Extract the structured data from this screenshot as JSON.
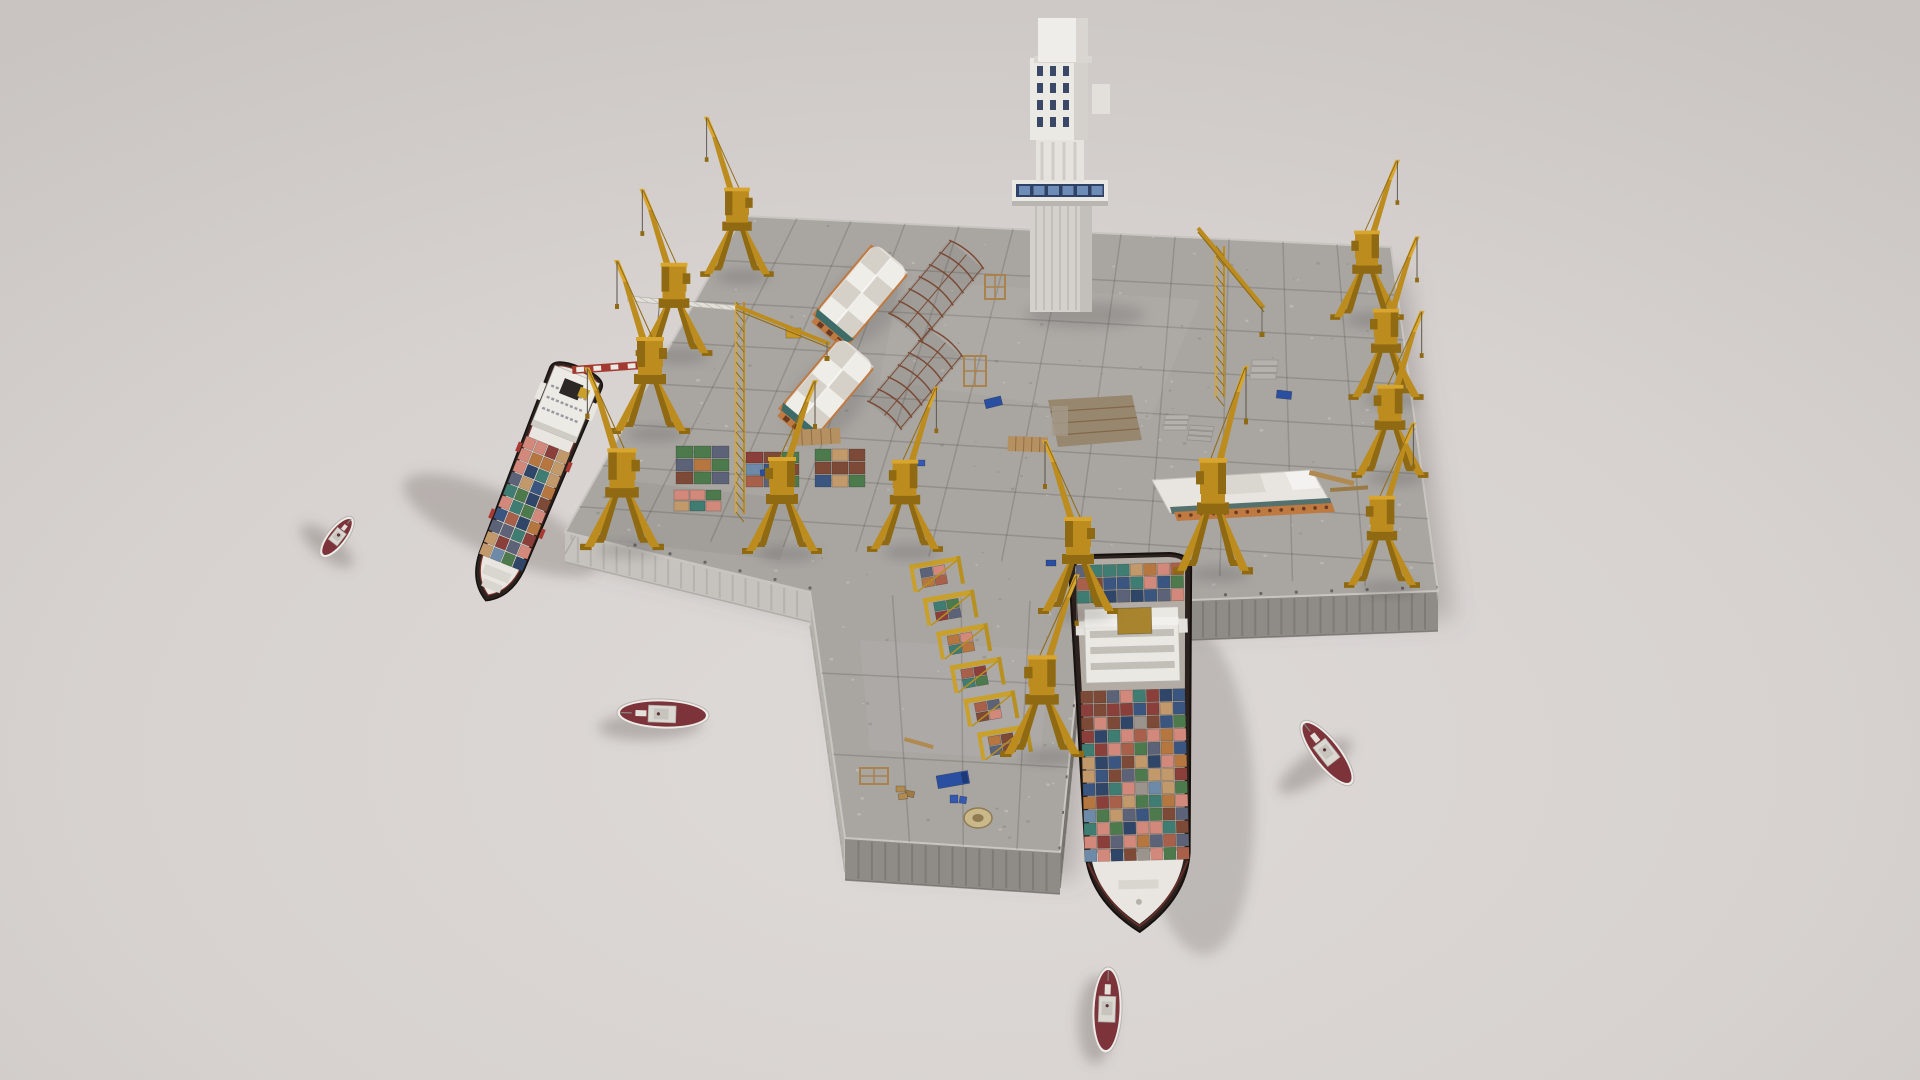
{
  "scene": {
    "description": "isometric-3d-render-of-cargo-harbor-diorama",
    "background": {
      "inner": "#dedad8",
      "mid": "#d7d2d0",
      "outer": "#c9c4c2"
    },
    "colors": {
      "pier": "#a9a6a2",
      "pierRim": "#c9c6c1",
      "wallSE": "#8f8b87",
      "wallSEDark": "#6e6a66",
      "wallSW": "#c6c2bd",
      "wallSWDark": "#a5a19c",
      "gridLine": "rgba(70,65,60,0.22)",
      "crane": "#bd8c1e",
      "craneDark": "#8f6a12",
      "craneLight": "#d8a62f",
      "towerFace": "#ebe9e4",
      "towerShade": "#d4d1cc",
      "towerWindow": "#2f4266",
      "towerPane": "#6d8cb8",
      "warehouseRoof": "#e2ded6",
      "warehouseWall": "#bf7a42",
      "warehouseGable": "#3d6b68",
      "skeleton": "#7a4a35",
      "shipHullDark": "#2b211e",
      "shipDeck": "#e9e6e1",
      "shipRed": "#a83a32",
      "shipRim": "#7e352f",
      "tugHull": "#ecebe7",
      "tugDeck": "#7c333a",
      "tugCabin": "#dbd8d2",
      "shadow": "rgba(106,96,92,0.32)",
      "wood": "#b08a50",
      "blueItem": "#2a4fa0",
      "mustard": "#a8842e"
    },
    "palette": [
      "#7d4a38",
      "#3a5680",
      "#3f7d72",
      "#8a3f3b",
      "#c2996b",
      "#d2897b",
      "#4d7a4c",
      "#5c6277",
      "#a8604a",
      "#2f4668",
      "#b5763f",
      "#6d8ba8"
    ],
    "pier": {
      "surface": [
        [
          743,
          216
        ],
        [
          1391,
          247
        ],
        [
          1438,
          591
        ],
        [
          1190,
          600
        ],
        [
          1085,
          603
        ],
        [
          1060,
          852
        ],
        [
          845,
          838
        ],
        [
          810,
          592
        ],
        [
          565,
          532
        ]
      ],
      "walls": [
        {
          "i": 2,
          "j": 3,
          "drop": 40,
          "face": "SE"
        },
        {
          "i": 3,
          "j": 4,
          "drop": 40,
          "face": "SE"
        },
        {
          "i": 4,
          "j": 5,
          "drop": 36,
          "face": "SE"
        },
        {
          "i": 5,
          "j": 6,
          "drop": 42,
          "face": "SE"
        },
        {
          "i": 6,
          "j": 7,
          "drop": 34,
          "face": "SW"
        },
        {
          "i": 7,
          "j": 8,
          "drop": 30,
          "face": "SW"
        },
        {
          "i": 8,
          "j": 0,
          "drop": 22,
          "face": "SW"
        },
        {
          "i": 1,
          "j": 2,
          "drop": 10,
          "face": "SW"
        }
      ],
      "gridT": [
        0.14,
        0.27,
        0.4,
        0.53,
        0.66,
        0.79,
        0.92
      ],
      "gridSCount": 12,
      "armGridS": [
        0.3,
        0.55,
        0.8
      ],
      "armGridT": [
        0.33,
        0.66
      ],
      "speckles": 320
    },
    "pit": {
      "pts": [
        [
          1048,
          400
        ],
        [
          1132,
          395
        ],
        [
          1142,
          440
        ],
        [
          1058,
          447
        ]
      ],
      "fill": "#97876f",
      "frame": "#7a5a3a"
    },
    "tower": {
      "x": 1012,
      "note": "white-control-tower-with-blue-window-bands"
    },
    "warehouses": [
      {
        "cx": 860,
        "cy": 295,
        "rot": 40,
        "len": 100,
        "wid": 48
      },
      {
        "cx": 826,
        "cy": 389,
        "rot": 40,
        "len": 100,
        "wid": 48
      }
    ],
    "skeletons": [
      {
        "cx": 936,
        "cy": 291,
        "rot": 40,
        "len": 95,
        "wid": 45
      },
      {
        "cx": 915,
        "cy": 379,
        "rot": 40,
        "len": 95,
        "wid": 45
      }
    ],
    "flat_building": {
      "roof": [
        [
          1152,
          480
        ],
        [
          1312,
          470
        ],
        [
          1330,
          502
        ],
        [
          1170,
          513
        ]
      ],
      "band": [
        [
          1170,
          507
        ],
        [
          1330,
          498
        ],
        [
          1332,
          505
        ],
        [
          1172,
          514
        ]
      ],
      "arcade": [
        [
          1174,
          512
        ],
        [
          1332,
          503
        ],
        [
          1335,
          512
        ],
        [
          1177,
          521
        ]
      ],
      "arches": 14
    },
    "container_stacks": [
      {
        "x": 676,
        "y": 446,
        "cols": 3,
        "rows": 3,
        "cw": 18,
        "ch": 13,
        "seed": 11
      },
      {
        "x": 746,
        "y": 452,
        "cols": 3,
        "rows": 3,
        "cw": 18,
        "ch": 12,
        "seed": 12
      },
      {
        "x": 815,
        "y": 449,
        "cols": 3,
        "rows": 3,
        "cw": 17,
        "ch": 13,
        "seed": 13
      },
      {
        "x": 674,
        "y": 490,
        "cols": 3,
        "rows": 2,
        "cw": 16,
        "ch": 11,
        "seed": 14
      }
    ],
    "rack_row": {
      "x1": 938,
      "y1": 580,
      "x2": 1006,
      "y2": 748,
      "frames": 6
    },
    "cranes": [
      {
        "x": 737,
        "y": 275,
        "s": 0.92,
        "flip": 1
      },
      {
        "x": 674,
        "y": 354,
        "s": 0.96,
        "flip": 1
      },
      {
        "x": 650,
        "y": 432,
        "s": 1.0,
        "flip": 1
      },
      {
        "x": 622,
        "y": 548,
        "s": 1.05,
        "flip": 1
      },
      {
        "x": 782,
        "y": 552,
        "s": 1.0,
        "flip": 0
      },
      {
        "x": 905,
        "y": 550,
        "s": 0.95,
        "flip": 0
      },
      {
        "x": 1078,
        "y": 612,
        "s": 1.0,
        "flip": 1
      },
      {
        "x": 1042,
        "y": 755,
        "s": 1.05,
        "flip": 0
      },
      {
        "x": 1213,
        "y": 572,
        "s": 1.0,
        "flip": 0,
        "tall": 1
      },
      {
        "x": 1367,
        "y": 318,
        "s": 0.92,
        "flip": 0
      },
      {
        "x": 1386,
        "y": 398,
        "s": 0.94,
        "flip": 0
      },
      {
        "x": 1390,
        "y": 476,
        "s": 0.96,
        "flip": 0
      },
      {
        "x": 1382,
        "y": 586,
        "s": 0.95,
        "flip": 0
      }
    ],
    "tower_cranes": [
      {
        "mx": 1220,
        "yTop": 246,
        "h": 152,
        "boom": [
          1198,
          228,
          1264,
          308
        ],
        "hook": [
          1262,
          306,
          26
        ]
      },
      {
        "mx": 740,
        "yTop": 302,
        "h": 212,
        "boom": [
          736,
          306,
          830,
          344
        ],
        "hook": [
          827,
          342,
          14
        ]
      }
    ],
    "beams": {
      "striped": {
        "x": 572,
        "y": 366,
        "w": 86,
        "h": 8,
        "rot": -4,
        "red": "#a23a31",
        "stripes": 5
      },
      "lattice": {
        "x": 628,
        "y": 296,
        "w": 108,
        "h": 5,
        "rot": 5,
        "hook": [
          660,
          303,
          48
        ]
      }
    },
    "ships": {
      "left": {
        "x": 575,
        "y": 380,
        "rot": 22,
        "beam": 56,
        "len": 250,
        "seed": 21
      },
      "right": {
        "x": 1130,
        "y": 562,
        "rot": -1.5,
        "beam": 122,
        "len": 374,
        "seed": 22
      }
    },
    "tugboats": [
      {
        "x": 337,
        "y": 537,
        "rot": 38,
        "len": 50,
        "beam": 20
      },
      {
        "x": 663,
        "y": 714,
        "rot": -88,
        "len": 92,
        "beam": 30
      },
      {
        "x": 1327,
        "y": 753,
        "rot": -38,
        "len": 80,
        "beam": 28
      },
      {
        "x": 1107,
        "y": 1010,
        "rot": 2,
        "len": 86,
        "beam": 30
      }
    ],
    "shadows": [
      {
        "x": 500,
        "y": 525,
        "rx": 105,
        "ry": 32,
        "rot": 24,
        "o": 0.3
      },
      {
        "x": 1196,
        "y": 790,
        "rx": 58,
        "ry": 165,
        "rot": -3,
        "o": 0.26
      },
      {
        "x": 327,
        "y": 546,
        "rx": 32,
        "ry": 12,
        "rot": 38,
        "o": 0.34
      },
      {
        "x": 650,
        "y": 726,
        "rx": 52,
        "ry": 14,
        "rot": -2,
        "o": 0.34
      },
      {
        "x": 1315,
        "y": 766,
        "rx": 44,
        "ry": 14,
        "rot": -35,
        "o": 0.34
      },
      {
        "x": 1096,
        "y": 1020,
        "rx": 18,
        "ry": 44,
        "rot": 2,
        "o": 0.34
      }
    ],
    "small_items": [
      {
        "t": "box",
        "x": 936,
        "y": 776,
        "w": 32,
        "h": 13,
        "c": "#2a4fa0",
        "rot": -10,
        "name": "blue-truck"
      },
      {
        "t": "box",
        "x": 950,
        "y": 795,
        "w": 8,
        "h": 8,
        "c": "#3558b0",
        "rot": 0,
        "name": "blue-crate"
      },
      {
        "t": "box",
        "x": 960,
        "y": 796,
        "w": 7,
        "h": 7,
        "c": "#3558b0",
        "rot": 8,
        "name": "blue-crate"
      },
      {
        "t": "coil",
        "x": 978,
        "y": 818,
        "w": 28,
        "h": 20,
        "c": "#c9b88a",
        "rot": 0,
        "name": "rope-coil"
      },
      {
        "t": "box",
        "x": 896,
        "y": 786,
        "w": 9,
        "h": 6,
        "c": "#b08a50",
        "rot": 0,
        "name": "pallet"
      },
      {
        "t": "box",
        "x": 906,
        "y": 790,
        "w": 9,
        "h": 6,
        "c": "#a07a42",
        "rot": 12,
        "name": "pallet"
      },
      {
        "t": "box",
        "x": 898,
        "y": 794,
        "w": 9,
        "h": 6,
        "c": "#b08a50",
        "rot": -8,
        "name": "pallet"
      },
      {
        "t": "rack",
        "x": 860,
        "y": 768,
        "w": 28,
        "h": 16,
        "c": "#a9824e",
        "rot": 0,
        "name": "wood-rack"
      },
      {
        "t": "rack",
        "x": 964,
        "y": 356,
        "w": 22,
        "h": 30,
        "c": "#a9824e",
        "rot": 0,
        "name": "wood-rack"
      },
      {
        "t": "rack",
        "x": 985,
        "y": 275,
        "w": 20,
        "h": 24,
        "c": "#a9824e",
        "rot": 0,
        "name": "wood-rack"
      },
      {
        "t": "box",
        "x": 984,
        "y": 400,
        "w": 17,
        "h": 9,
        "c": "#2a4fa0",
        "rot": -14,
        "name": "blue-container"
      },
      {
        "t": "box",
        "x": 1277,
        "y": 390,
        "w": 15,
        "h": 8,
        "c": "#2a4fa0",
        "rot": 6,
        "name": "blue-container"
      },
      {
        "t": "slab",
        "x": 1252,
        "y": 360,
        "w": 26,
        "h": 20,
        "c": "#b5b2ae",
        "rot": 0,
        "name": "concrete-stack"
      },
      {
        "t": "slab",
        "x": 1165,
        "y": 415,
        "w": 24,
        "h": 16,
        "c": "#b5b2ae",
        "rot": 0,
        "name": "concrete-stack"
      },
      {
        "t": "slab",
        "x": 1190,
        "y": 425,
        "w": 24,
        "h": 16,
        "c": "#aeaba7",
        "rot": 4,
        "name": "concrete-stack"
      },
      {
        "t": "plank",
        "x": 1310,
        "y": 470,
        "w": 46,
        "h": 5,
        "c": "#b08a50",
        "rot": 14,
        "name": "plank"
      },
      {
        "t": "plank",
        "x": 1330,
        "y": 488,
        "w": 38,
        "h": 4,
        "c": "#9a7a45",
        "rot": -4,
        "name": "plank"
      },
      {
        "t": "plank",
        "x": 905,
        "y": 737,
        "w": 30,
        "h": 4,
        "c": "#b08a50",
        "rot": 16,
        "name": "plank"
      },
      {
        "t": "box",
        "x": 786,
        "y": 328,
        "w": 15,
        "h": 10,
        "c": "#c9972a",
        "rot": 0,
        "name": "yellow-vehicle"
      },
      {
        "t": "box",
        "x": 916,
        "y": 460,
        "w": 9,
        "h": 6,
        "c": "#3558b0",
        "rot": 0,
        "name": "blue-crate"
      },
      {
        "t": "deck",
        "x": 792,
        "y": 430,
        "w": 48,
        "h": 16,
        "c": "#b59060",
        "rot": -3,
        "name": "pallet-deck"
      },
      {
        "t": "deck",
        "x": 1008,
        "y": 436,
        "w": 40,
        "h": 15,
        "c": "#b59060",
        "rot": 2,
        "name": "pallet-deck"
      },
      {
        "t": "box",
        "x": 1046,
        "y": 560,
        "w": 10,
        "h": 6,
        "c": "#2a4fa0",
        "rot": 0,
        "name": "blue-crate"
      },
      {
        "t": "box",
        "x": 760,
        "y": 470,
        "w": 10,
        "h": 6,
        "c": "#2a4fa0",
        "rot": -6,
        "name": "blue-crate"
      }
    ]
  }
}
